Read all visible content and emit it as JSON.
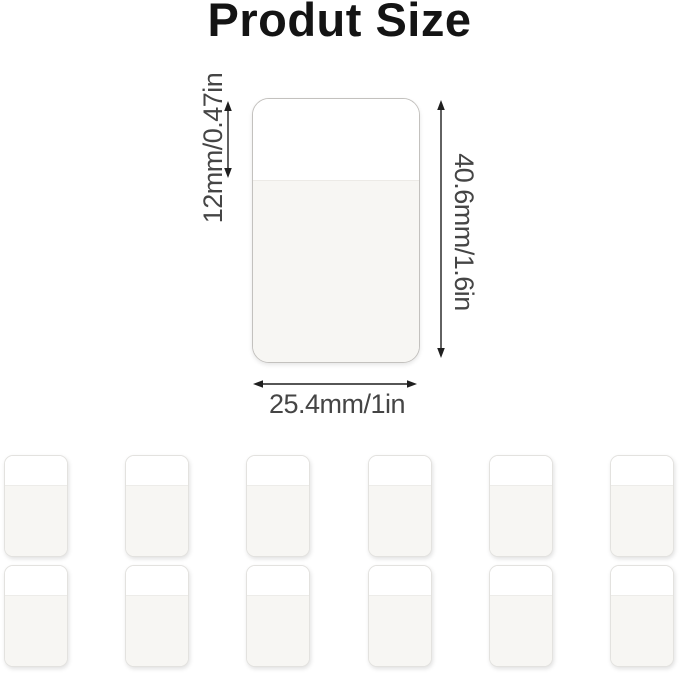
{
  "title": "Produt Size",
  "product": {
    "description": "clear adhesive tab shown with measurement arrows",
    "dimensions": {
      "top_section_height": "12mm/0.47in",
      "total_height": "40.6mm/1.6in",
      "width": "25.4mm/1in"
    }
  },
  "gallery": {
    "rows": 2,
    "columns": 6,
    "count": 12
  },
  "colors": {
    "title-text": "#141414",
    "dimension-text": "#454545",
    "arrow-color": "#1f1f1f",
    "product-border": "#c3c1be",
    "product-clear-fill": "#ffffff",
    "product-body-fill": "#f7f6f3",
    "thumb-border": "#e3e2df"
  }
}
